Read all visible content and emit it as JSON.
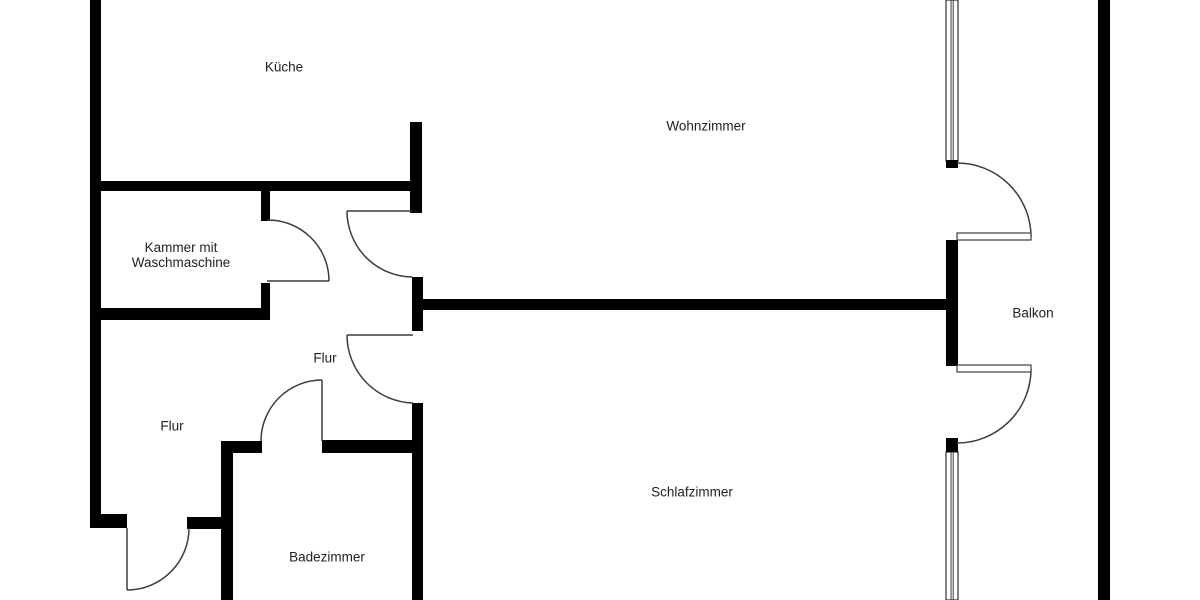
{
  "title": "Wohnung Grundriss",
  "canvas": {
    "width": 1200,
    "height": 600
  },
  "colors": {
    "background": "#ffffff",
    "wall": "#000000",
    "thin_line": "#3d3d3d",
    "text": "#222222"
  },
  "label_font_size": 13.5,
  "label_line_height": 15,
  "rooms": [
    {
      "id": "kueche",
      "lines": [
        "Küche"
      ],
      "cx": 284,
      "cy": 67
    },
    {
      "id": "wohnzimmer",
      "lines": [
        "Wohnzimmer"
      ],
      "cx": 706,
      "cy": 126
    },
    {
      "id": "kammer",
      "lines": [
        "Kammer mit",
        "Waschmaschine"
      ],
      "cx": 181,
      "cy": 255
    },
    {
      "id": "flur-oben",
      "lines": [
        "Flur"
      ],
      "cx": 325,
      "cy": 358
    },
    {
      "id": "flur-unten",
      "lines": [
        "Flur"
      ],
      "cx": 172,
      "cy": 426
    },
    {
      "id": "schlafzimmer",
      "lines": [
        "Schlafzimmer"
      ],
      "cx": 692,
      "cy": 492
    },
    {
      "id": "badezimmer",
      "lines": [
        "Badezimmer"
      ],
      "cx": 327,
      "cy": 557
    },
    {
      "id": "balkon",
      "lines": [
        "Balkon"
      ],
      "cx": 1033,
      "cy": 313
    }
  ],
  "walls": [
    {
      "id": "outer-left",
      "x": 90,
      "y": 0,
      "w": 11,
      "h": 528
    },
    {
      "id": "kueche-sued",
      "x": 90,
      "y": 181,
      "w": 332,
      "h": 10
    },
    {
      "id": "kueche-wohnzimmer",
      "x": 410,
      "y": 122,
      "w": 12,
      "h": 91
    },
    {
      "id": "kammer-ost-oben",
      "x": 261,
      "y": 188,
      "w": 9,
      "h": 33
    },
    {
      "id": "kammer-ost-unten",
      "x": 261,
      "y": 283,
      "w": 9,
      "h": 36
    },
    {
      "id": "kammer-sued",
      "x": 90,
      "y": 308,
      "w": 180,
      "h": 12
    },
    {
      "id": "flur-steg-mitte",
      "x": 412,
      "y": 277,
      "w": 11,
      "h": 54
    },
    {
      "id": "wohn-schlaf-trennwand",
      "x": 418,
      "y": 299,
      "w": 530,
      "h": 11
    },
    {
      "id": "schlaf-west",
      "x": 412,
      "y": 403,
      "w": 11,
      "h": 197
    },
    {
      "id": "bad-nord-links",
      "x": 221,
      "y": 441,
      "w": 41,
      "h": 12
    },
    {
      "id": "bad-nord-rechts",
      "x": 322,
      "y": 440,
      "w": 101,
      "h": 13
    },
    {
      "id": "bad-west",
      "x": 221,
      "y": 441,
      "w": 12,
      "h": 159
    },
    {
      "id": "flur-sued-links",
      "x": 90,
      "y": 514,
      "w": 37,
      "h": 14
    },
    {
      "id": "flur-sued-rechts",
      "x": 187,
      "y": 517,
      "w": 45,
      "h": 12
    },
    {
      "id": "balkon-fenster-block-1",
      "x": 946,
      "y": 160,
      "w": 12,
      "h": 8
    },
    {
      "id": "balkon-mittelwand",
      "x": 946,
      "y": 240,
      "w": 12,
      "h": 126
    },
    {
      "id": "balkon-fenster-block-2",
      "x": 946,
      "y": 438,
      "w": 12,
      "h": 14
    },
    {
      "id": "outer-right",
      "x": 1098,
      "y": 0,
      "w": 12,
      "h": 600
    }
  ],
  "doors": [
    {
      "id": "kammer-tuer",
      "leaf": {
        "type": "line",
        "x1": 267,
        "y1": 281,
        "x2": 329,
        "y2": 281
      },
      "arc": "M267 220 A61 61 0 0 1 329 281"
    },
    {
      "id": "flur-tuer-oben",
      "leaf": {
        "type": "line",
        "x1": 347,
        "y1": 211,
        "x2": 412,
        "y2": 211
      },
      "arc": "M347 211 A66 66 0 0 0 412 277"
    },
    {
      "id": "flur-tuer-unten",
      "leaf": {
        "type": "line",
        "x1": 347,
        "y1": 335,
        "x2": 413,
        "y2": 335
      },
      "arc": "M347 335 A68 68 0 0 0 413 403"
    },
    {
      "id": "badezimmer-tuer",
      "leaf": {
        "type": "line",
        "x1": 322,
        "y1": 380,
        "x2": 322,
        "y2": 441
      },
      "arc": "M322 380 A61 61 0 0 0 261 441"
    },
    {
      "id": "wohnungstuer",
      "leaf": {
        "type": "line",
        "x1": 127,
        "y1": 528,
        "x2": 127,
        "y2": 590
      },
      "arc": "M127 590 A62 62 0 0 0 189 528"
    },
    {
      "id": "balkon-tuer-oben",
      "leaf": {
        "type": "rect",
        "x": 957,
        "y": 233,
        "w": 74,
        "h": 7
      },
      "arc": "M957 163 A74 74 0 0 1 1031 237"
    },
    {
      "id": "balkon-tuer-unten",
      "leaf": {
        "type": "rect",
        "x": 957,
        "y": 365,
        "w": 74,
        "h": 7
      },
      "arc": "M1031 369 A74 74 0 0 1 957 443"
    }
  ],
  "windows": [
    {
      "id": "balkon-fenster-oben",
      "x": 946,
      "y": 0,
      "w": 12,
      "h": 161
    },
    {
      "id": "balkon-fenster-unten",
      "x": 946,
      "y": 452,
      "w": 12,
      "h": 148
    }
  ]
}
